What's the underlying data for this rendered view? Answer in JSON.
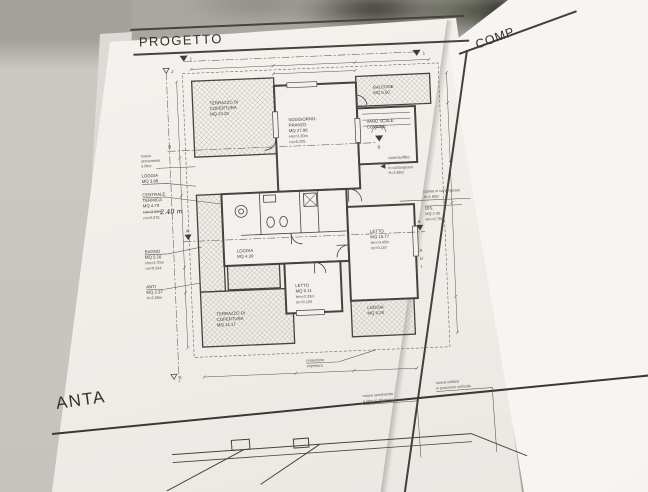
{
  "sheets": {
    "progetto": {
      "title": "PROGETTO"
    },
    "comp": {
      "title": "COMP"
    },
    "pianta": {
      "title": "ANTA"
    }
  },
  "plan": {
    "rooms": {
      "terrazzo_tl": [
        "TERRAZZO DI",
        "COPERTURA",
        "MQ 20.28"
      ],
      "soggiorno": [
        "SOGGIORNO-",
        "PRANZO",
        "MQ 27.96",
        "Hm=3.30m",
        "rm=0.205"
      ],
      "balcone": [
        "BALCONE",
        "MQ 5.50"
      ],
      "vano_scale": [
        "VANO SCALE",
        "COMUNE"
      ],
      "letto_grande": [
        "LETTO",
        "MQ 15.77",
        "Hm=3.45m",
        "rm=0.187"
      ],
      "letto_piccolo": [
        "LETTO",
        "MQ 9.11",
        "Hm=3.33m",
        "rm=0.193"
      ],
      "terrazzo_bl": [
        "TERRAZZO DI",
        "COPERTURA",
        "MQ 14.17"
      ],
      "loggia_br": [
        "LOGGIA",
        "MQ 9.28"
      ],
      "loggia_centro": [
        "LOGGIA",
        "MQ 4.39"
      ],
      "dis": [
        "DIS.",
        "MQ 2.40",
        "Hm=2.70m"
      ]
    },
    "left_labels": {
      "serramento": [
        "nuovo",
        "serramento",
        "a libro"
      ],
      "loggia": [
        "LOGGIA",
        "MQ 3.98"
      ],
      "centrale": [
        "CENTRALE",
        "TERMICA",
        "MQ 4.79"
      ],
      "centrale_hm_printed": "Hm=2.64m",
      "centrale_hm_hand": "2.40 m",
      "centrale_rm": "rm=0.676",
      "bagno": [
        "BAGNO",
        "MQ 5.16",
        "Hm=2.70m",
        "rm=0.244"
      ],
      "anti": [
        "ANTI",
        "MQ 2.37",
        "H=2.60m"
      ]
    },
    "right_labels": {
      "controsoffitto": [
        "controsoffitto",
        "piano",
        "in cartongesso",
        "H=2.80m"
      ],
      "parete": [
        "parete in cartongesso",
        "H=2.80m"
      ],
      "aui": [
        "A",
        "U",
        "I"
      ]
    },
    "bottom_label": {
      "proiezione": [
        "proiezione",
        "copertura"
      ]
    },
    "markers": {
      "s1": "1",
      "s2": "2",
      "sA": "A",
      "sB": "B"
    }
  },
  "lower_sheet": {
    "labels": {
      "serramento": [
        "nuovo serramento",
        "a libro in alluminio"
      ],
      "caldaia": [
        "nuova caldaia",
        "in posizione verticale"
      ]
    }
  }
}
